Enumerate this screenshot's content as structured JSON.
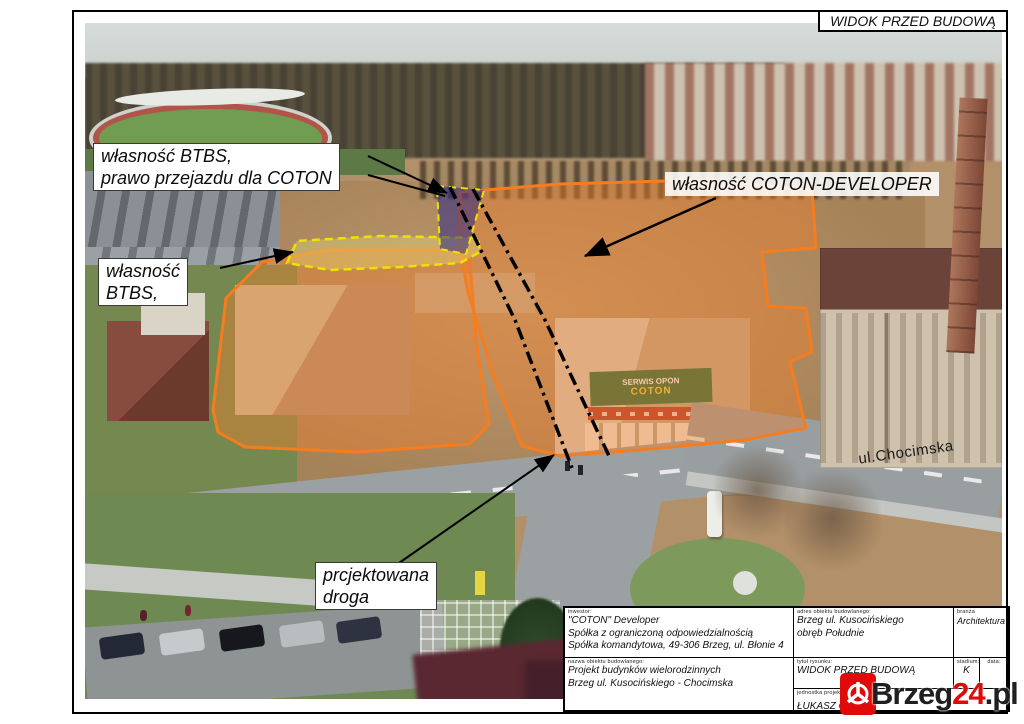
{
  "frame": {
    "drawing_view_title": "WIDOK PRZED BUDOWĄ"
  },
  "labels": {
    "btbs_right_of_way": {
      "line1": "własność BTBS,",
      "line2": "prawo przejazdu dla COTON"
    },
    "coton_developer": "własność COTON-DEVELOPER",
    "btbs": {
      "line1": "własność",
      "line2": "BTBS,"
    },
    "projected_road": {
      "line1": "prcjektowana",
      "line2": "droga"
    },
    "street": "ul.Chocimska"
  },
  "photo": {
    "tire_service_sign": {
      "line1": "SERWIS OPON",
      "line2": "COTON"
    }
  },
  "title_block": {
    "investor": {
      "header": "inwestor:",
      "line1": "\"COTON\" Developer",
      "line2": "Spółka z ograniczoną odpowiedzialnością",
      "line3": "Spółka komandytowa, 49-306 Brzeg, ul. Błonie 4"
    },
    "site_address": {
      "header": "adres obiektu budowlanego:",
      "line1": "Brzeg ul. Kusocińskiego",
      "line2": "obręb Południe"
    },
    "branch": {
      "header": "branża",
      "value": "Architektura"
    },
    "object_name": {
      "header": "nazwa obiektu budowlanego:",
      "line1": "Projekt budynków wielorodzinnych",
      "line2": "Brzeg ul. Kusocińskiego - Chocimska"
    },
    "drawing_title": {
      "header": "tytuł rysunku:",
      "value": "WIDOK PRZED BUDOWĄ"
    },
    "stage": {
      "header": "stadium:",
      "value": "K"
    },
    "date": {
      "header": "data:",
      "value": ""
    },
    "designer": {
      "header": "jednostka projektowa:",
      "name": "ŁUKASZ CHRU",
      "address": "ul. Górne 197, 49-306 Brzeg"
    }
  },
  "watermark": {
    "brand_black": "Brzeg",
    "brand_red": "24",
    "brand_suffix": ".pl"
  },
  "colors": {
    "overlay_orange": "#f57d20",
    "overlay_yellow": "#ece400",
    "overlay_blue": "#1e1e8c",
    "watermark_red": "#e10a0a",
    "annotation_black": "#111111"
  }
}
